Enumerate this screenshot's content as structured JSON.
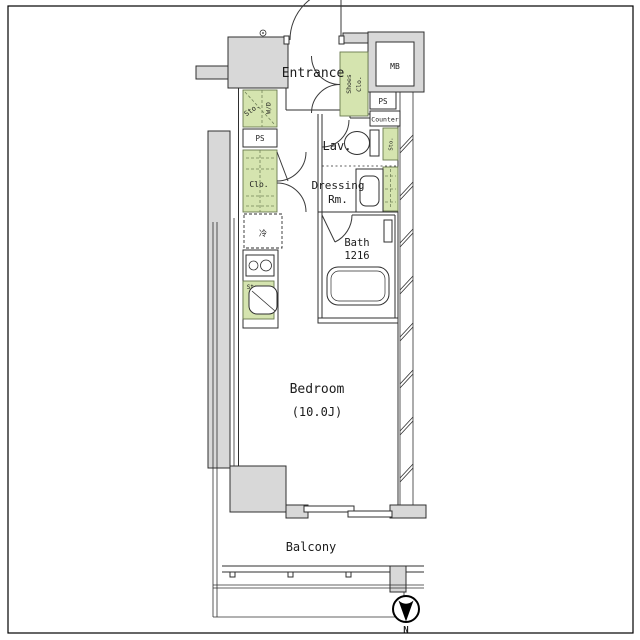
{
  "floorplan": {
    "title": "studio apartment floor plan",
    "labels": {
      "entrance": "Entrance",
      "shoes_line1": "Shoes",
      "shoes_line2": "Clo.",
      "mb": "MB",
      "ps_right": "PS",
      "counter": "Counter",
      "lav": "Lav.",
      "toilet_sto": "Sto.",
      "dressing_line1": "Dressing",
      "dressing_line2": "Rm.",
      "bath_line1": "Bath",
      "bath_line2": "1216",
      "sto_wd_sto": "Sto.",
      "sto_wd_wd": "W/D",
      "ps_left": "PS",
      "clo": "Clo.",
      "fridge": "冷",
      "kitchen_sto": "Sto.",
      "bedroom_line1": "Bedroom",
      "bedroom_line2": "(10.0J)",
      "balcony": "Balcony",
      "compass_north": "N"
    },
    "colors": {
      "wall_fill": "#d8d8d8",
      "storage_fill": "#d5e4af",
      "line": "#2f2f2f"
    }
  }
}
